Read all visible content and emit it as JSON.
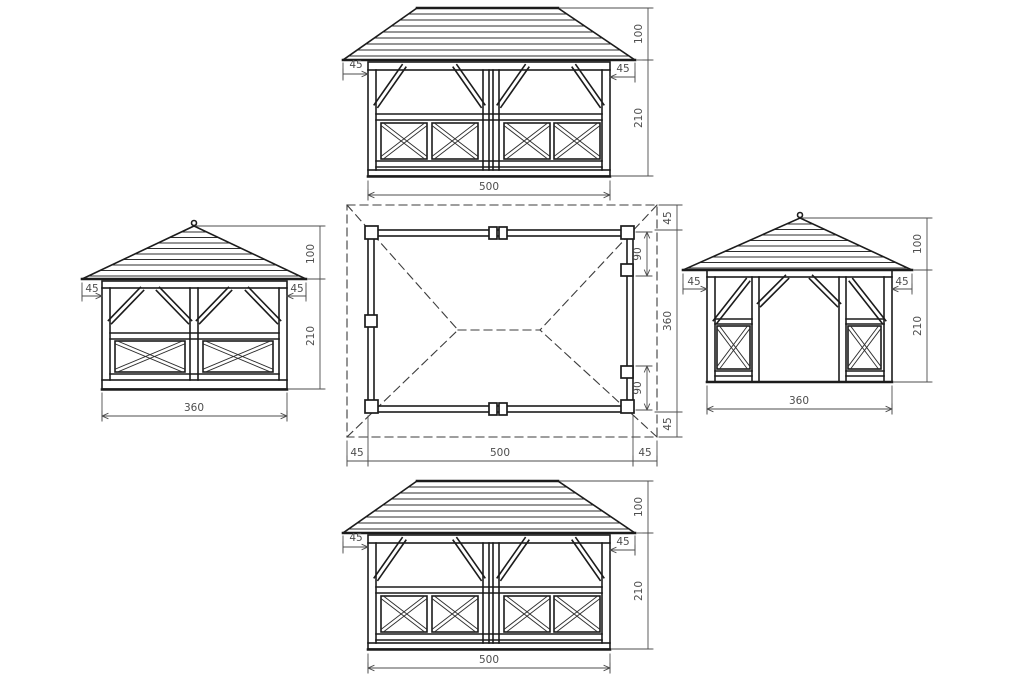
{
  "views": {
    "front": {
      "dims": {
        "width": "500",
        "roof_height": "100",
        "wall_height": "210",
        "overhang_left": "45",
        "overhang_right": "45"
      }
    },
    "rear": {
      "dims": {
        "width": "500",
        "roof_height": "100",
        "wall_height": "210",
        "overhang_left": "45",
        "overhang_right": "45"
      }
    },
    "left": {
      "dims": {
        "width": "360",
        "roof_height": "100",
        "wall_height": "210",
        "overhang_left": "45",
        "overhang_right": "45"
      }
    },
    "right": {
      "dims": {
        "width": "360",
        "roof_height": "100",
        "wall_height": "210",
        "overhang_left": "45",
        "overhang_right": "45"
      }
    },
    "plan": {
      "dims": {
        "width": "500",
        "depth": "360",
        "overhang_left": "45",
        "overhang_right": "45",
        "overhang_top": "45",
        "overhang_bottom": "45",
        "door_offset_top": "90",
        "door_offset_bottom": "90"
      }
    }
  },
  "colors": {
    "line": "#1c1c1c",
    "dimension": "#4d4d4d",
    "background": "#ffffff"
  }
}
